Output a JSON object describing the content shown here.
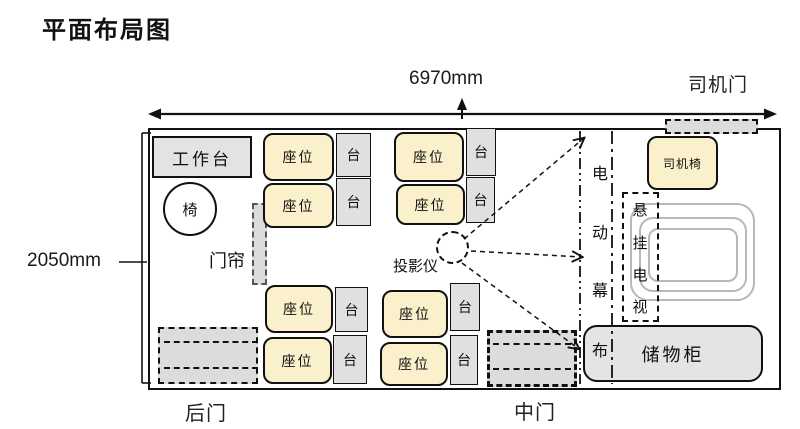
{
  "title": "平面布局图",
  "dimensions": {
    "width_label": "6970mm",
    "height_label": "2050mm"
  },
  "labels": {
    "driver_door": "司机门",
    "rear_door": "后门",
    "middle_door": "中门",
    "workbench": "工作台",
    "chair": "椅",
    "door_curtain": "门帘",
    "seat": "座位",
    "table": "台",
    "projector": "投影仪",
    "driver_seat": "司机椅",
    "storage_cabinet": "储物柜"
  },
  "vertical_labels": {
    "electric_screen": [
      "电",
      "动",
      "幕",
      "布"
    ],
    "hanging_tv": [
      "悬",
      "挂",
      "电",
      "视"
    ]
  },
  "colors": {
    "seat_fill": "#FAF0CB",
    "furniture_fill": "#E3E3E3",
    "door_fill": "#DCDCDC",
    "ring_border": "#B8B8B8",
    "line_color": "#111111"
  }
}
